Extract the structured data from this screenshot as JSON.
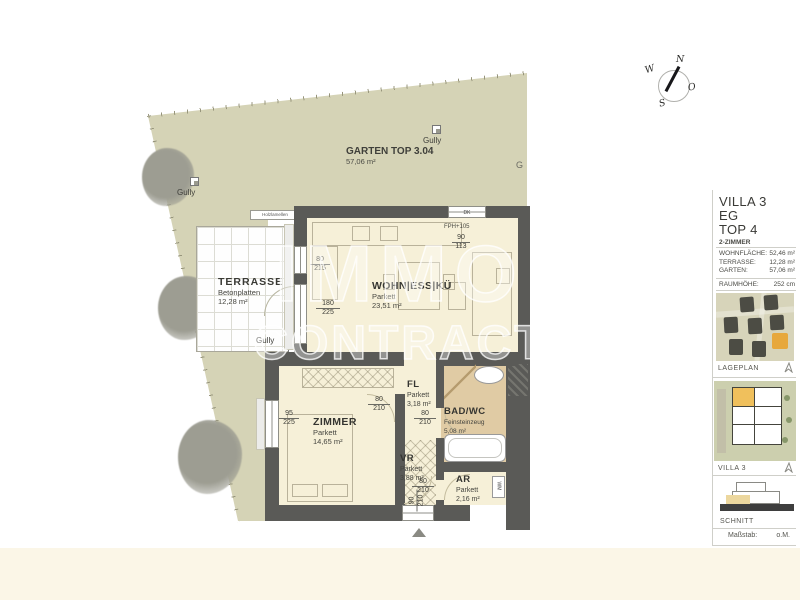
{
  "compass": {
    "n": "N",
    "w": "W",
    "s": "S",
    "o": "O"
  },
  "watermark": {
    "line1": "IMMO",
    "line2": "CONTRACT"
  },
  "garden": {
    "title": "GARTEN TOP 3.04",
    "area": "57,06 m²",
    "gully": "Gully",
    "partial_label": "G"
  },
  "terrace": {
    "title": "TERRASSE",
    "floor": "Betonplatten",
    "area": "12,28 m²",
    "note": "Holzlamellen",
    "gully": "Gully"
  },
  "rooms": {
    "living": {
      "name": "WOHN|ESS|KÜ",
      "floor": "Parkett",
      "area": "23,51 m²"
    },
    "zimmer": {
      "name": "ZIMMER",
      "floor": "Parkett",
      "area": "14,65 m²"
    },
    "fl": {
      "name": "FL",
      "floor": "Parkett",
      "area": "3,18 m²"
    },
    "bad": {
      "name": "BAD/WC",
      "floor": "Feinsteinzeug",
      "area": "5,08 m²"
    },
    "vr": {
      "name": "VR",
      "floor": "Parkett",
      "area": "3,88 m²"
    },
    "ar": {
      "name": "AR",
      "floor": "Parkett",
      "area": "2,16 m²"
    }
  },
  "dims": {
    "kitchen_window": {
      "w": "80",
      "h": "215"
    },
    "terrace_door": {
      "w": "180",
      "h": "225"
    },
    "zimmer_window": {
      "w": "95",
      "h": "225"
    },
    "zimmer_door": {
      "w": "80",
      "h": "210"
    },
    "bad_door": {
      "w": "80",
      "h": "210"
    },
    "ar_door": {
      "w": "80",
      "h": "210"
    },
    "entry_door": {
      "w": "90",
      "h": "210"
    },
    "top_window": {
      "w": "90",
      "h": "113"
    },
    "dk": "DK",
    "fph": "FPH+105",
    "wm": "WM"
  },
  "sidebar": {
    "title_lines": [
      "VILLA 3",
      "EG",
      "TOP 4"
    ],
    "subtitle": "2-ZIMMER",
    "metrics": [
      {
        "label": "WOHNFLÄCHE:",
        "value": "52,46 m²"
      },
      {
        "label": "TERRASSE:",
        "value": "12,28 m²"
      },
      {
        "label": "GARTEN:",
        "value": "57,06 m²"
      }
    ],
    "room_height": {
      "label": "RAUMHÖHE:",
      "value": "252 cm"
    },
    "thumbs": {
      "lageplan": "LAGEPLAN",
      "villa": "VILLA 3",
      "schnitt": "SCHNITT"
    },
    "scale": {
      "label": "Maßstab:",
      "value": "o.M."
    }
  },
  "colors": {
    "accent_orange": "#e7a83d",
    "garden_green": "#d5d3b6",
    "bath_tan": "#e0cba4",
    "wall_gray": "#5a5a57"
  }
}
